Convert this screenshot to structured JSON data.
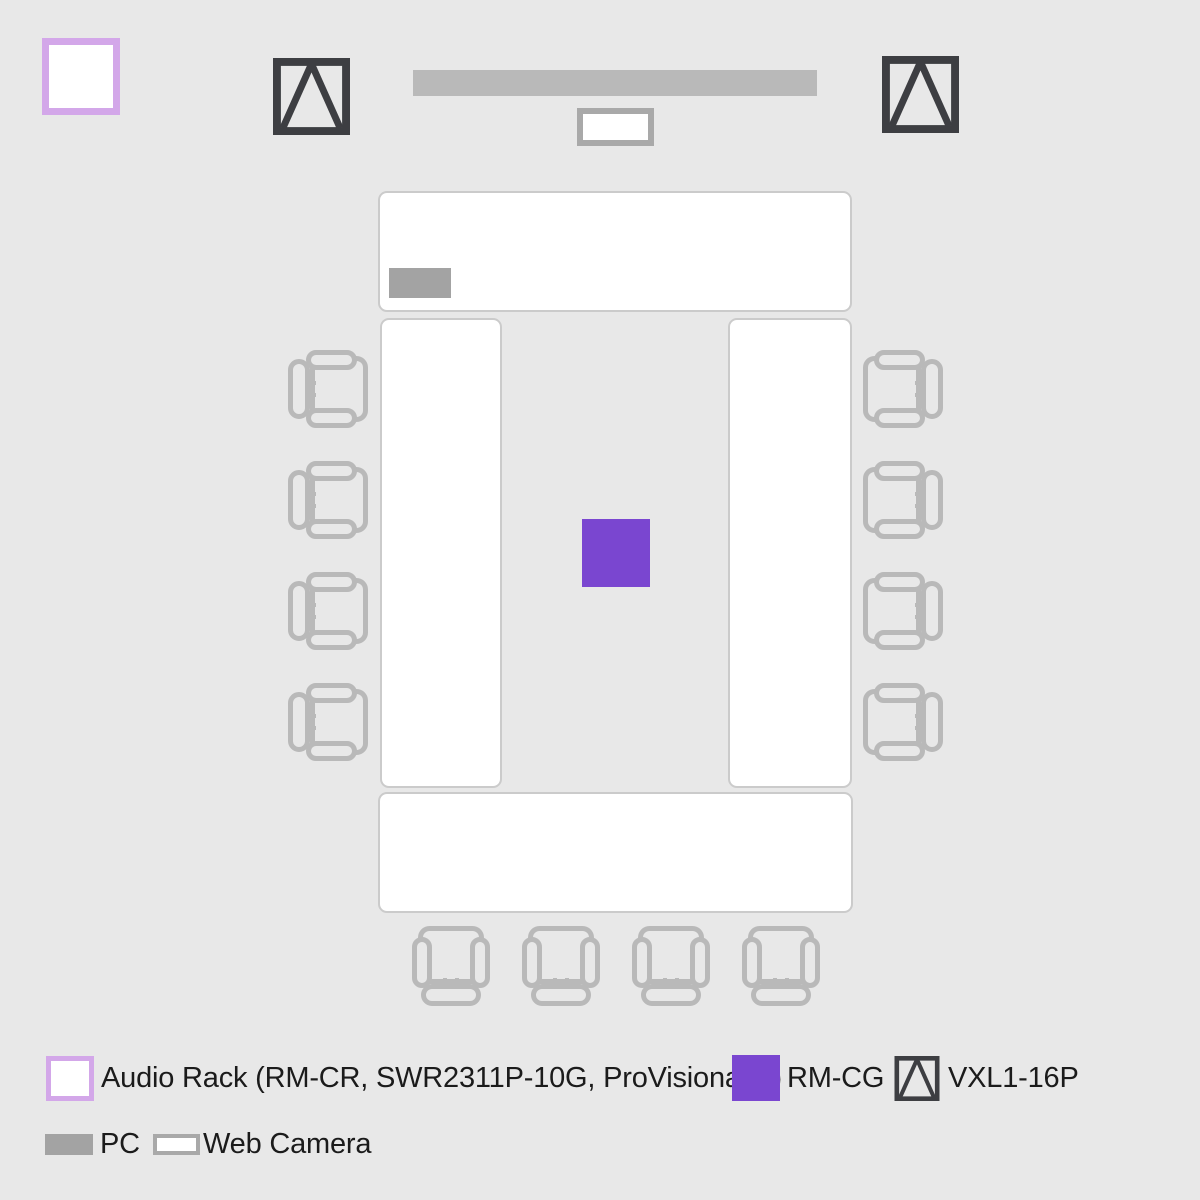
{
  "page": {
    "description": "Conference room audio/video equipment layout diagram, top view",
    "background": "#e8e8e8"
  },
  "colors": {
    "background": "#e8e8e8",
    "table_fill": "#ffffff",
    "table_border": "#cbcbcb",
    "chair_stroke": "#b9b9b9",
    "display_bar": "#b9b9b9",
    "pc": "#a3a3a3",
    "web_camera_border": "#a9a9a9",
    "audio_rack_border": "#d3a7e9",
    "rm_cg_purple": "#7a46d0",
    "vxl_dark": "#3d3e42",
    "legend_text": "#1b1b1b"
  },
  "room": {
    "tables": {
      "count": 4,
      "arrangement": "hollow rectangle"
    },
    "chairs": {
      "left_count": 4,
      "right_count": 4,
      "bottom_count": 4,
      "icon": "chair-icon"
    },
    "audio_rack": {
      "icon": "audio-rack-icon"
    },
    "vxl_speakers": {
      "count": 2,
      "icon": "vxl1-16p-speaker-icon"
    },
    "display": {
      "icon": "display-bar-icon"
    },
    "web_camera": {
      "icon": "web-camera-icon"
    },
    "pc": {
      "icon": "pc-icon"
    },
    "rm_cg": {
      "icon": "rm-cg-ceiling-mic-icon"
    }
  },
  "legend": {
    "items": [
      {
        "id": "audio_rack",
        "label": "Audio Rack (RM-CR, SWR2311P-10G, ProVisionaire)",
        "swatch": "white square with light purple border"
      },
      {
        "id": "rm_cg",
        "label": "RM-CG",
        "swatch": "solid purple square"
      },
      {
        "id": "vxl",
        "label": "VXL1-16P",
        "swatch": "dark outlined square with triangle"
      },
      {
        "id": "pc",
        "label": "PC",
        "swatch": "solid gray rectangle"
      },
      {
        "id": "web_camera",
        "label": "Web Camera",
        "swatch": "white rectangle with gray border"
      }
    ]
  }
}
